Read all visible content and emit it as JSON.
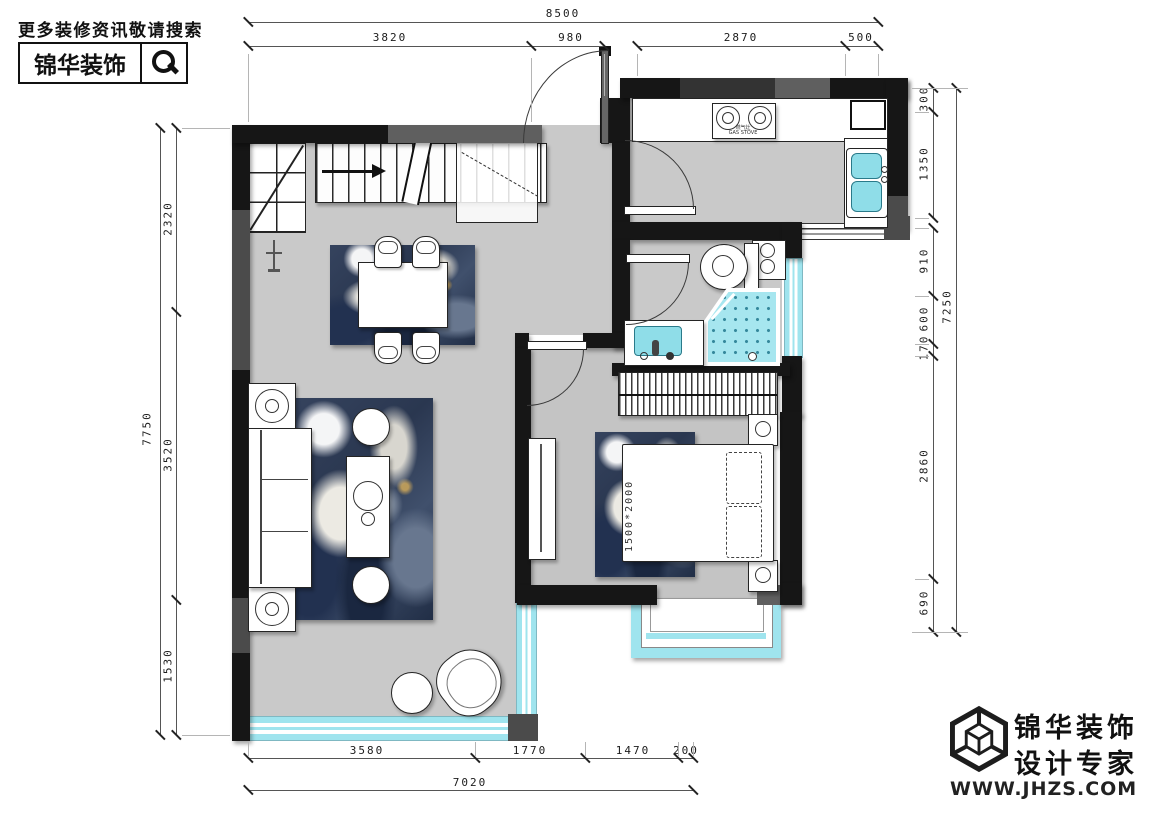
{
  "header": {
    "tagline": "更多装修资讯敬请搜索",
    "brand": "锦华装饰",
    "search_icon": "magnifier-icon"
  },
  "footer": {
    "brand_line1": "锦华装饰",
    "brand_line2": "设计专家",
    "website": "WWW.JHZS.COM",
    "logo": "cube-wireframe-logo"
  },
  "plan": {
    "bed_label": "1500*2000",
    "stove_label_cn": "燃气灶",
    "stove_label_en": "GAS STOVE"
  },
  "dims": {
    "top": {
      "overall": "8500",
      "seg1": "3820",
      "seg2": "980",
      "seg3": "2870",
      "seg4": "500"
    },
    "left": {
      "overall": "7750",
      "seg1": "2320",
      "seg2": "3520",
      "seg3": "1530"
    },
    "right": {
      "overall": "7250",
      "seg1": "300",
      "seg2": "1350",
      "seg3": "910",
      "seg4": "600",
      "seg5": "170",
      "seg6": "2860",
      "seg7": "690"
    },
    "bottom": {
      "overall": "7020",
      "seg1": "3580",
      "seg2": "1770",
      "seg3": "1470",
      "seg4": "200"
    }
  },
  "colors": {
    "wall": "#161616",
    "floor": "#c9c9c9",
    "window_cyan": "#9fe4ee",
    "fixture_cyan": "#8fdde8",
    "rug_navy": "#2a3750"
  }
}
